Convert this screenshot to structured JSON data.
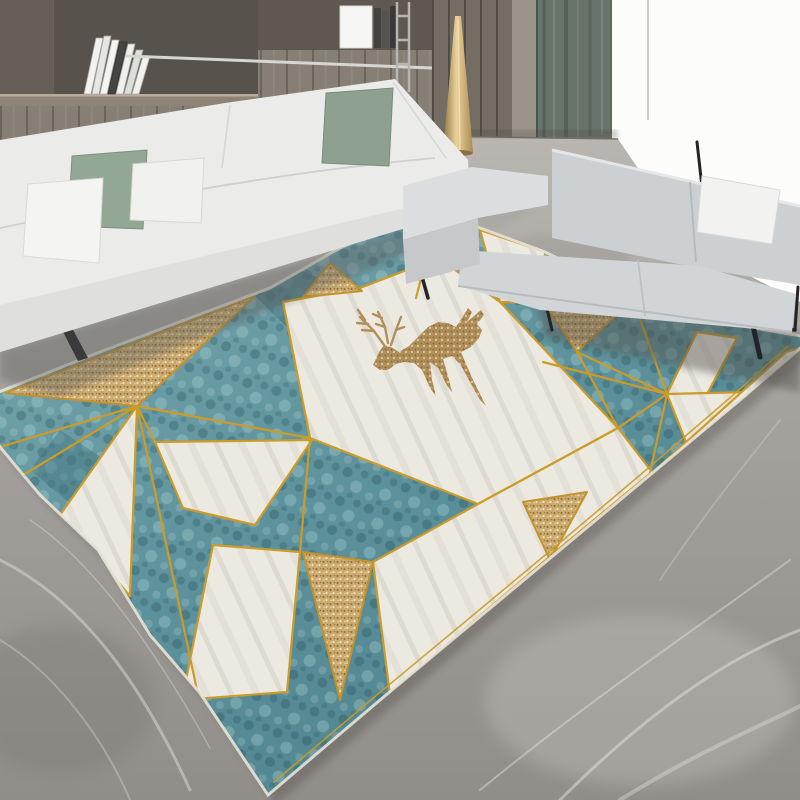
{
  "meta": {
    "description": "Product photograph: modern living room with a geometric nordic rug (teal, cream and gold triangles with a golden deer motif), white sofa, gray loveseat, wood shelving wall, green curtain and bright window over gray marble floor",
    "image_type": "photograph",
    "visible_text": "none"
  },
  "palette": {
    "rug_teal": "#5d929c",
    "rug_teal_dark": "#3c6d77",
    "rug_teal_light": "#9cc5ca",
    "rug_cream": "#ece9e1",
    "rug_gold_line": "#cc9b28",
    "rug_speckle_gold": "#c6a36a",
    "deer_gold": "#b2905c",
    "floor_gray": "#a19e99",
    "floor_vein": "#cac7c2",
    "sofa_white": "#ebebe9",
    "pillow_sage": "#93a795",
    "loveseat_gray": "#d0d3d6",
    "frame_black": "#26262a",
    "curtain_green": "#67746b",
    "wood_wall": "#877f75",
    "cabinet_wood": "#746d64",
    "cone_gold": "#c3a266",
    "window_white": "#fcfcfb"
  },
  "scene": {
    "room": "living room",
    "objects": [
      {
        "name": "bookshelf-wall",
        "desc": "gray wood shelving with leaning books and metal rail"
      },
      {
        "name": "metal-ladder",
        "desc": "thin metal ladder against shelving"
      },
      {
        "name": "wood-cabinet",
        "desc": "vertical plank cabinet"
      },
      {
        "name": "gold-cone-lamp",
        "desc": "slim gold cone floor lamp"
      },
      {
        "name": "curtain",
        "desc": "dark sage green curtain"
      },
      {
        "name": "window",
        "desc": "bright white window"
      },
      {
        "name": "sofa-left",
        "desc": "white fabric sofa, two sage and two white pillows, metal legs",
        "pillow_count": 4
      },
      {
        "name": "loveseat-right",
        "desc": "light gray loveseat with black metal frame and one white pillow",
        "pillow_count": 1
      },
      {
        "name": "rug",
        "desc": "geometric triangle rug: teal velvet, cream marble and gold-glitter facets divided by thin gold lines",
        "motif": "leaping golden deer with antlers"
      },
      {
        "name": "marble-floor",
        "desc": "gray marble floor with white veining"
      }
    ]
  }
}
